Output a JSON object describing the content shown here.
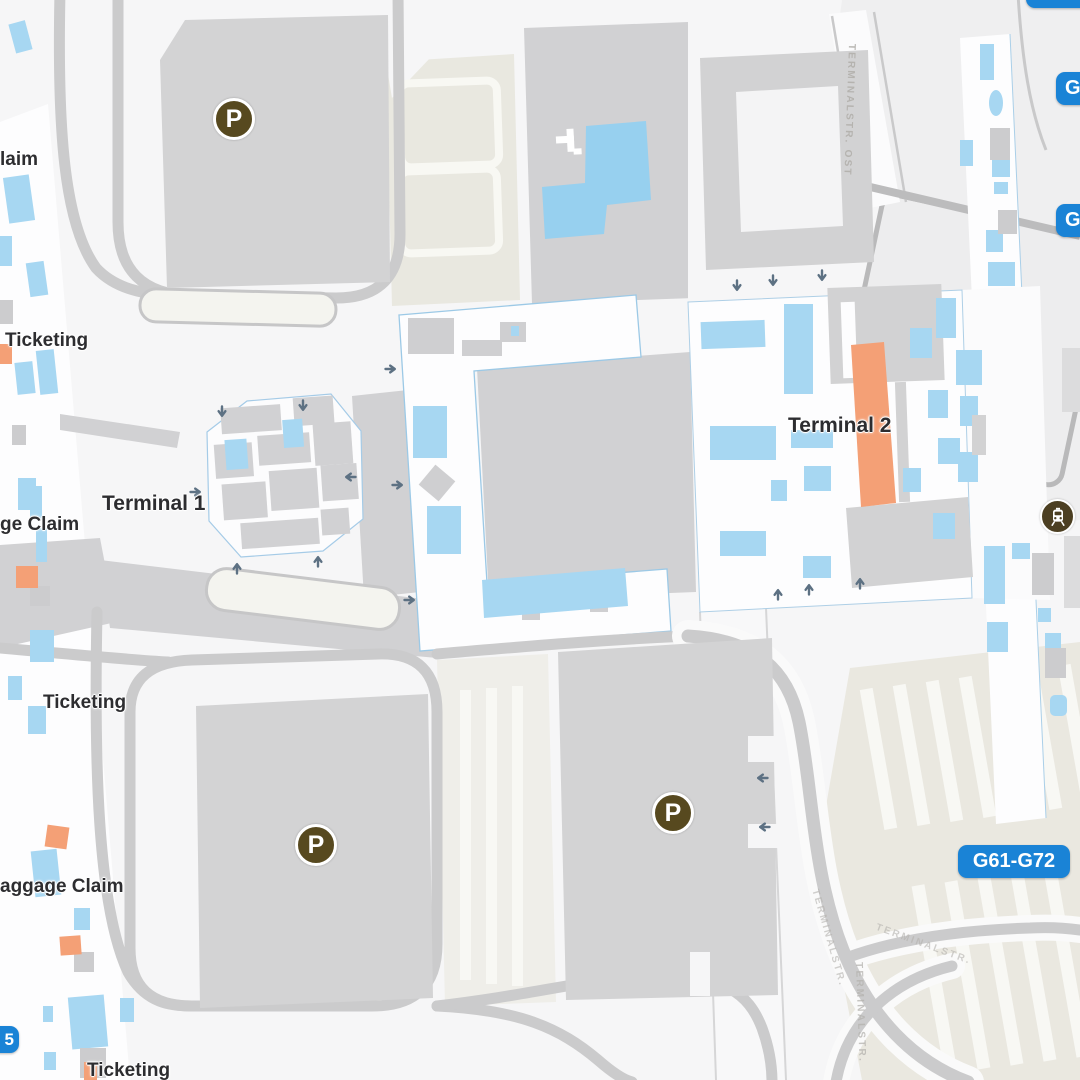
{
  "map": {
    "labels": {
      "terminal1": "Terminal 1",
      "terminal2": "Terminal 2",
      "baggage_claim_top": "laim",
      "ticketing_upper": "Ticketing",
      "baggage_claim_mid": "ge Claim",
      "ticketing_mid": "Ticketing",
      "baggage_claim_lower": "aggage Claim",
      "ticketing_bottom": "Ticketing"
    },
    "gates": {
      "g61_g72": "G61-G72",
      "partial_g": "G",
      "partial_5": "5"
    },
    "streets": {
      "terminalstr_ost": "TERMINALSTR. OST",
      "terminalstr": "TERMINALSTR."
    },
    "icons": {
      "parking_symbol": "P"
    },
    "colors": {
      "badge_blue": "#1a83d6",
      "area_blue": "#a7d7f2",
      "accent_orange": "#f4a076",
      "building_gray": "#d2d2d3",
      "road_gray": "#cbcbcc",
      "parking_icon_brown": "#57491f",
      "transit_icon_brown": "#4c3f22"
    }
  }
}
